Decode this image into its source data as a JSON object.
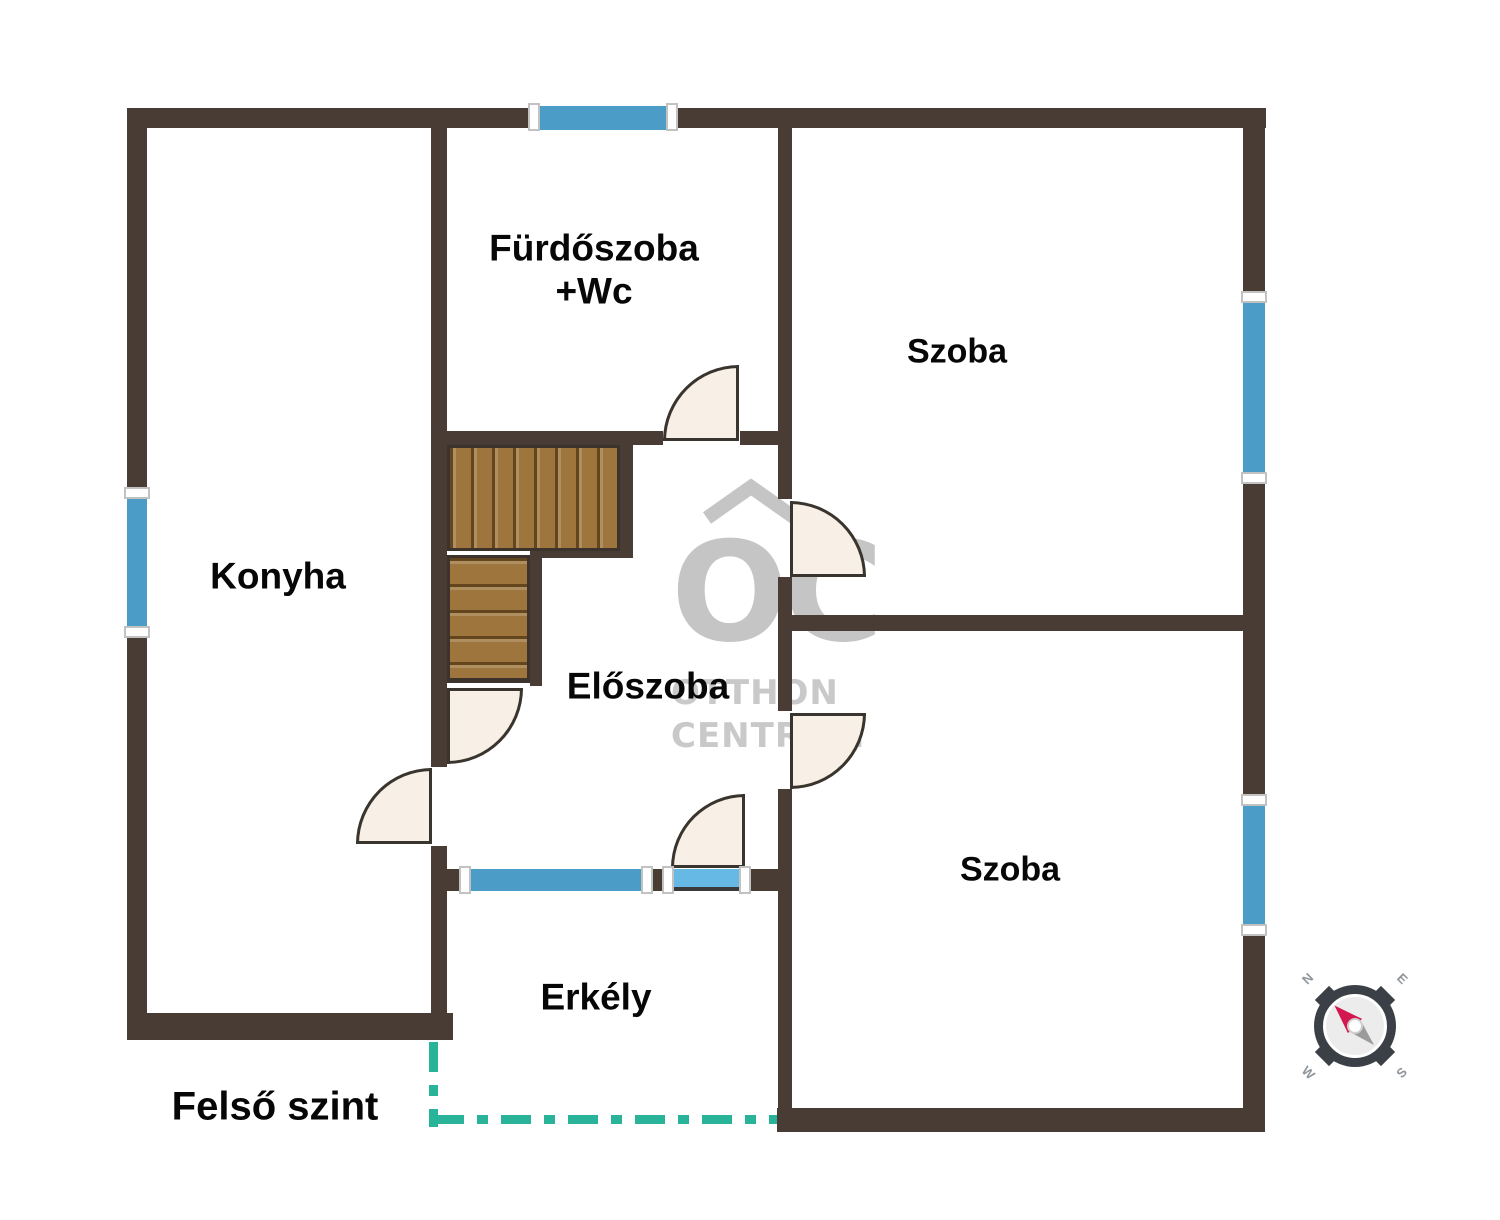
{
  "floor_title": "Felső szint",
  "rooms": {
    "bathroom": {
      "label_line1": "Fürdőszoba",
      "label_line2": "+Wc"
    },
    "room_top": {
      "label": "Szoba"
    },
    "kitchen": {
      "label": "Konyha"
    },
    "hallway": {
      "label": "Előszoba"
    },
    "room_bottom": {
      "label": "Szoba"
    },
    "balcony": {
      "label": "Erkély"
    }
  },
  "watermark": {
    "monogram": "OC",
    "line1": "OTTHON",
    "line2": "CENTRUM"
  },
  "compass": {
    "north": "N",
    "east": "E",
    "south": "S",
    "west": "W"
  },
  "colors": {
    "wall": "#493c34",
    "window": "#4c9cc8",
    "balcony_door_sill": "#66b9e4",
    "door_fill": "#f8f0e6",
    "stair_wood": "#9e753c",
    "dashed_outline": "#29b399",
    "watermark_gray": "#c5c5c5",
    "compass_needle_red": "#d3174f"
  }
}
